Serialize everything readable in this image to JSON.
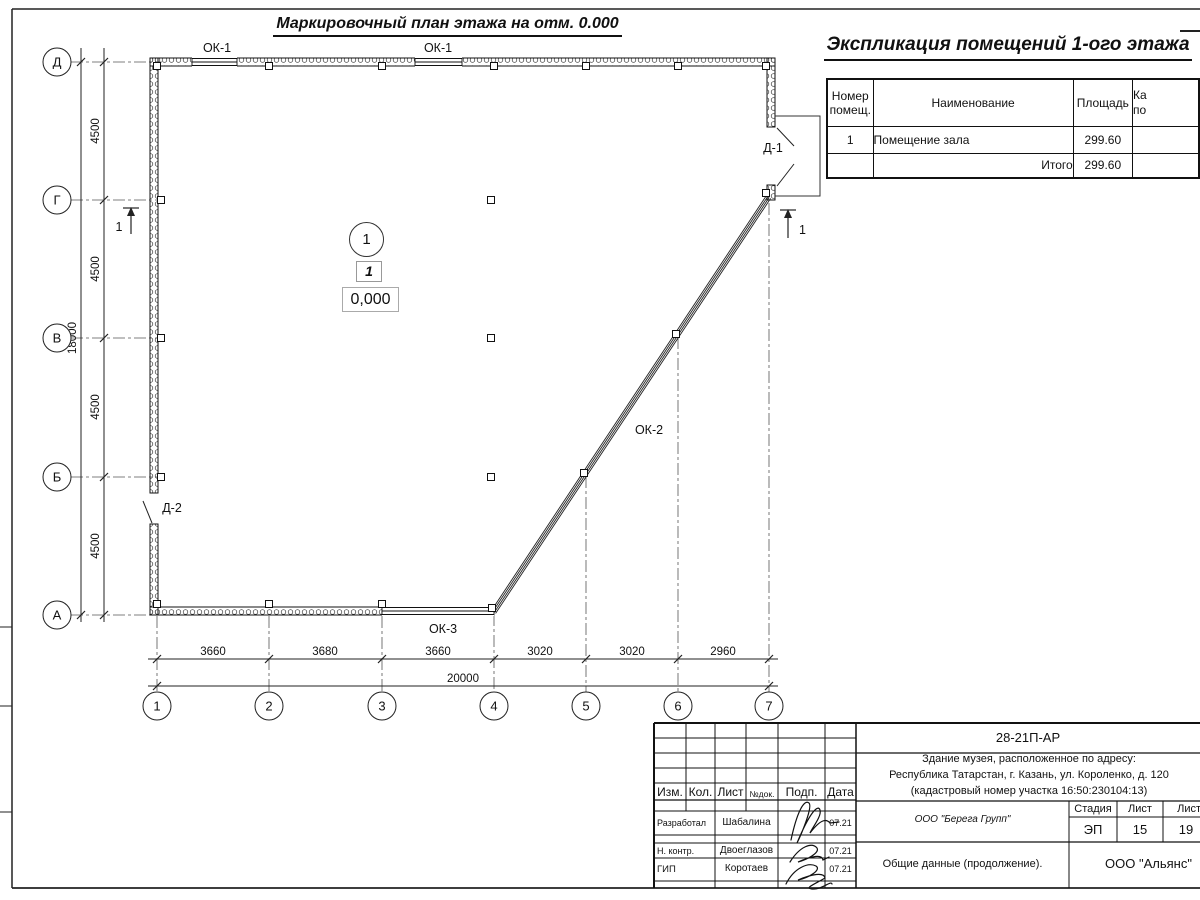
{
  "plan": {
    "title": "Маркировочный план этажа на отм. 0.000",
    "labels": {
      "ok1a": "ОК-1",
      "ok1b": "ОК-1",
      "ok2": "ОК-2",
      "ok3": "ОК-3",
      "d1": "Д-1",
      "d2": "Д-2",
      "section_left": "1",
      "section_right": "1"
    },
    "room": {
      "number_circle": "1",
      "number_box": "1",
      "elevation": "0,000"
    },
    "axes_h": [
      "1",
      "2",
      "3",
      "4",
      "5",
      "6",
      "7"
    ],
    "axes_v": [
      "Д",
      "Г",
      "В",
      "Б",
      "А"
    ],
    "dims_bottom": [
      "3660",
      "3680",
      "3660",
      "3020",
      "3020",
      "2960"
    ],
    "dim_bottom_total": "20000",
    "dims_left": [
      "4500",
      "4500",
      "4500",
      "4500"
    ],
    "dim_left_total": "18000"
  },
  "explication": {
    "title": "Экспликация помещений 1-ого этажа",
    "headers": {
      "number_l1": "Номер",
      "number_l2": "помещ.",
      "name": "Наименование",
      "area": "Площадь",
      "cat_l1": "Ка",
      "cat_l2": "по"
    },
    "rows": [
      {
        "number": "1",
        "name": "Помещение зала",
        "area": "299.60"
      }
    ],
    "total_label": "Итого",
    "total_area": "299.60"
  },
  "titleblock": {
    "doc_number": "28-21П-АР",
    "address": [
      "Здание музея, расположенное по адресу:",
      "Республика Татарстан, г. Казань, ул. Короленко, д. 120",
      "(кадастровый номер участка 16:50:230104:13)"
    ],
    "cols": {
      "izm": "Изм.",
      "kol": "Кол.",
      "list": "Лист",
      "ndok": "№док.",
      "podp": "Подп.",
      "date": "Дата"
    },
    "people": [
      {
        "role": "Разработал",
        "name": "Шабалина",
        "date": "07.21"
      },
      {
        "role": "Н. контр.",
        "name": "Двоеглазов",
        "date": "07.21"
      },
      {
        "role": "ГИП",
        "name": "Коротаев",
        "date": "07.21"
      }
    ],
    "company": "ООО \"Берега Групп\"",
    "stage_label": "Стадия",
    "sheet_label": "Лист",
    "sheets_label": "Листов",
    "stage": "ЭП",
    "sheet": "15",
    "sheets": "19",
    "doc_title": "Общие данные (продолжение).",
    "company2": "ООО \"Альянс\""
  }
}
